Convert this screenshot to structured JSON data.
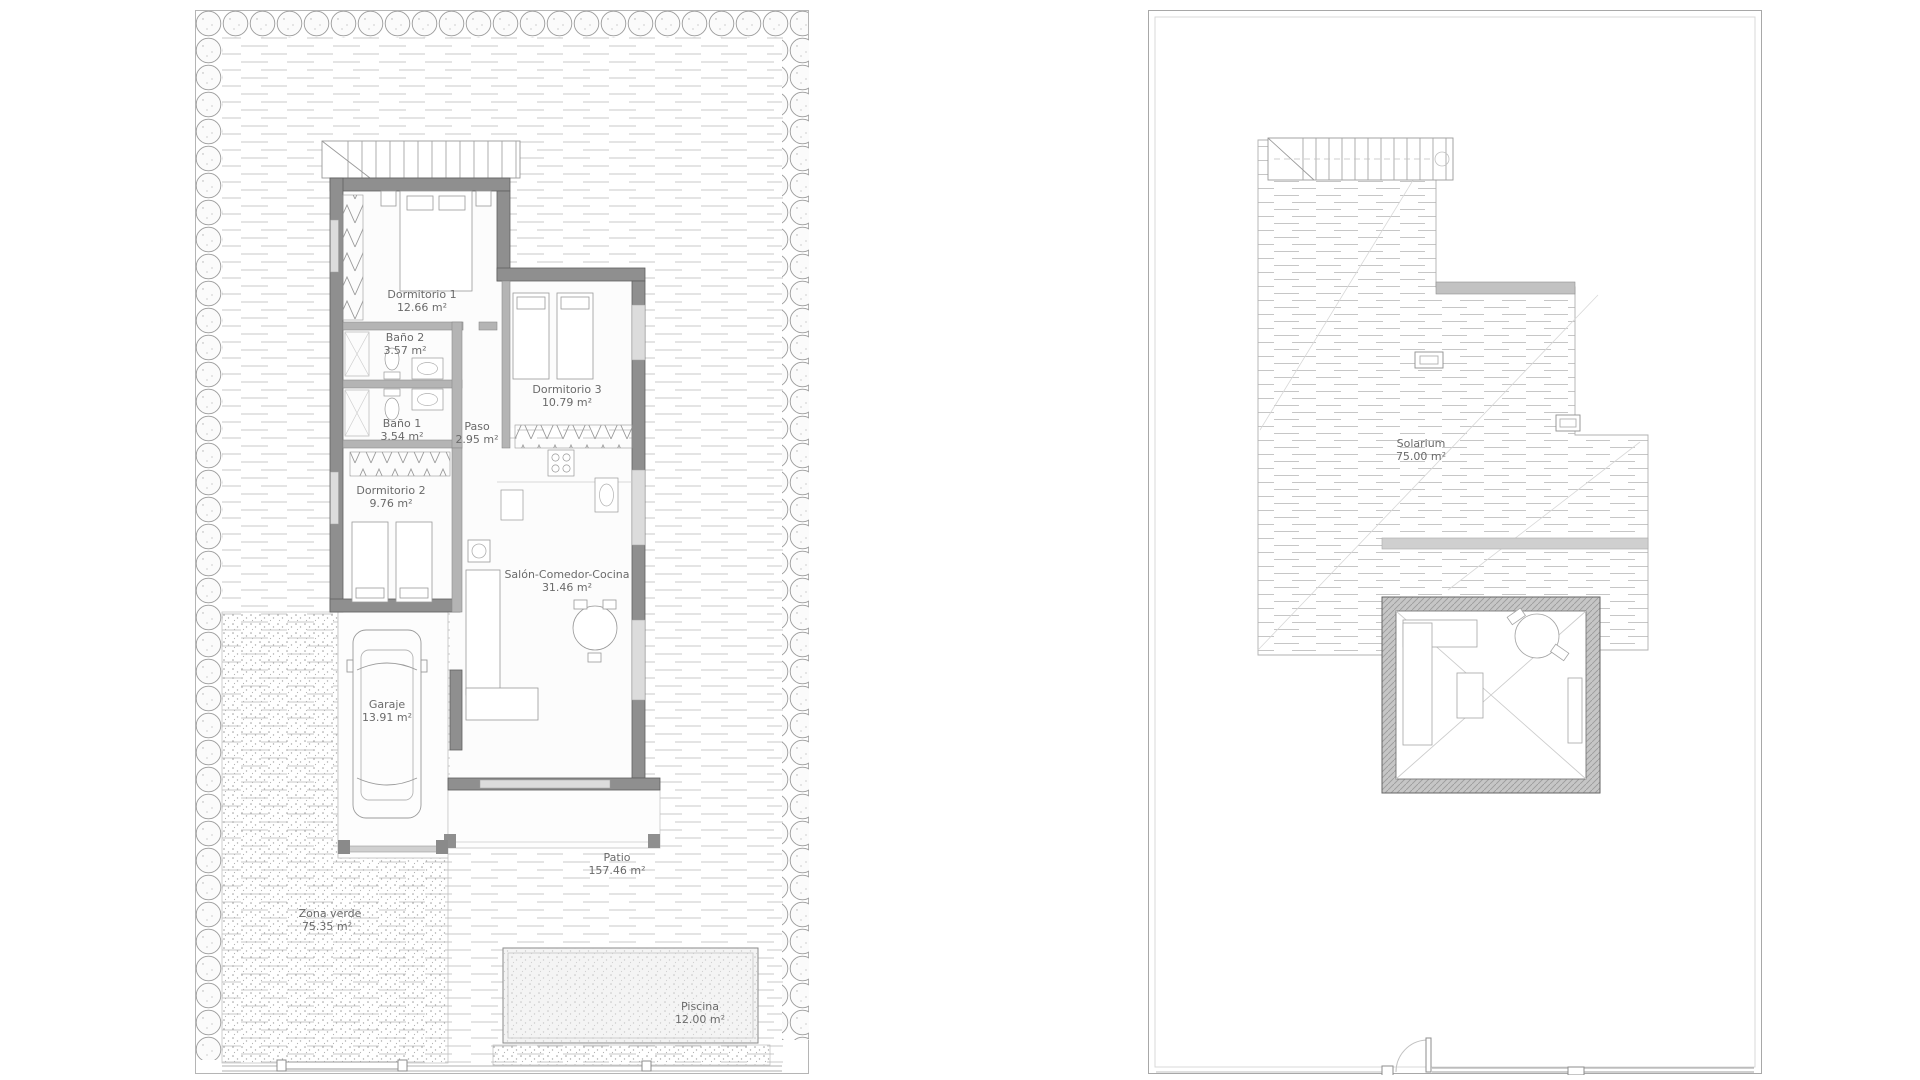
{
  "sheet": {
    "description": "Villa floor plan drawing, two plans side by side",
    "colors": {
      "wall_exterior": "#8f8f8f",
      "wall_interior": "#b4b4b4",
      "window": "#dcdcdc",
      "hatch": "#c8c8c8",
      "stipple": "#a0a0a0",
      "label_text": "#6a6a6a",
      "background": "#ffffff"
    }
  },
  "plans": [
    {
      "name": "ground-floor-plot-plan",
      "rooms": [
        {
          "label": "Dormitorio 1",
          "area": "12.66 m²"
        },
        {
          "label": "Baño 2",
          "area": "3.57 m²"
        },
        {
          "label": "Baño 1",
          "area": "3.54 m²"
        },
        {
          "label": "Paso",
          "area": "2.95 m²"
        },
        {
          "label": "Dormitorio 3",
          "area": "10.79 m²"
        },
        {
          "label": "Dormitorio 2",
          "area": "9.76 m²"
        },
        {
          "label": "Salón-Comedor-Cocina",
          "area": "31.46 m²"
        },
        {
          "label": "Garaje",
          "area": "13.91 m²"
        },
        {
          "label": "Patio",
          "area": "157.46 m²"
        },
        {
          "label": "Zona verde",
          "area": "75.35 m²"
        },
        {
          "label": "Piscina",
          "area": "12.00 m²"
        }
      ]
    },
    {
      "name": "roof-solarium-plan",
      "rooms": [
        {
          "label": "Solarium",
          "area": "75.00 m²"
        }
      ]
    }
  ]
}
